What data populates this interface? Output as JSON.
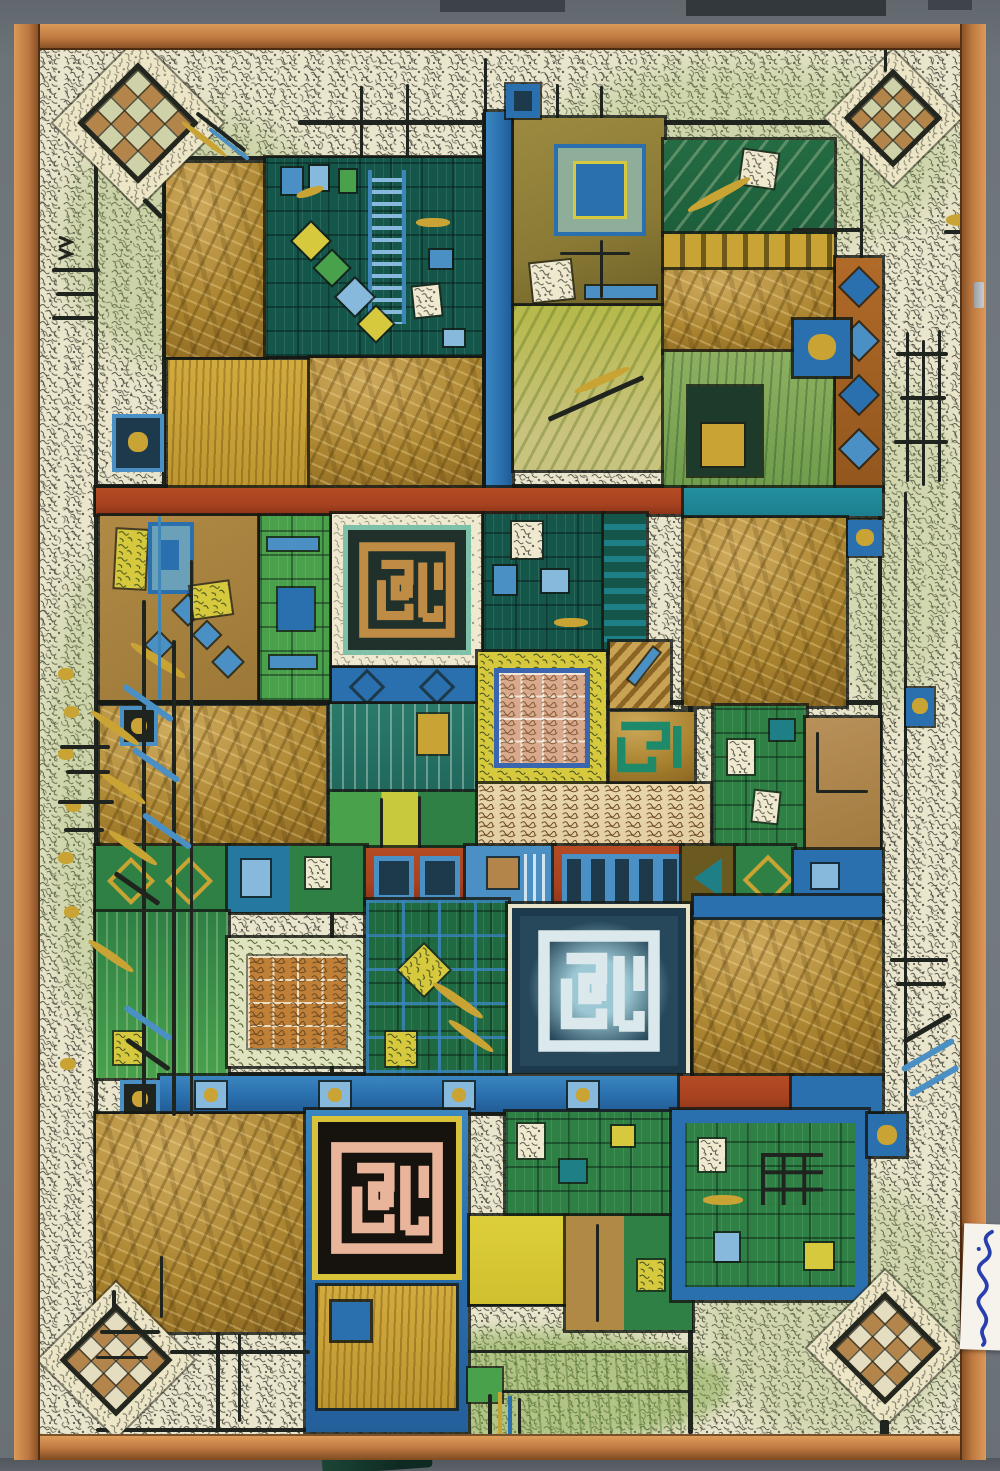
{
  "artwork": {
    "title": "Abstract calligraphic composition",
    "medium": "mixed-media painting in a wooden strip frame, photographed on a grey wall",
    "style": "square Kufic calligraphy, patchwork grid of gold, green, blue and rust panels over a dense script ground"
  },
  "palette": {
    "wall": "#6e757b",
    "wallDark": "#3c4247",
    "frame": "#bd7740",
    "frameLight": "#dc9a58",
    "frameDark": "#7e4a20",
    "canvas": "#eae6cd",
    "ink": "#20241e",
    "washGreen": "#8fae5e",
    "gold": "#a9832f",
    "goldLight": "#cda95c",
    "goldBright": "#c9a434",
    "tan": "#b3854a",
    "olive": "#8a7a35",
    "dkteal": "#14564a",
    "teal": "#1f7f86",
    "green": "#2e8044",
    "brightGreen": "#49a14c",
    "paleGreen": "#dfe3c0",
    "cobalt": "#2a6fae",
    "steel": "#4a90c4",
    "lightBlue": "#86b9dc",
    "navy": "#1c3a4c",
    "rust": "#a84320",
    "cream": "#efe9cf",
    "yellow": "#d6c93e",
    "pink": "#d8a98c",
    "mazePink": "#e8b49a",
    "manuscript": "#e2cda4",
    "manuscriptInk": "#6e4a22",
    "orange": "#c08038",
    "label": "#f5f3ec",
    "signature": "#2a3fae",
    "mazeGold": "#bf8c46",
    "mazeField": "#20302a",
    "mazeNavy": "#26485a",
    "mazeWhite": "#dce9ec",
    "mazeBlack": "#16120d",
    "mazeYellow": "#d8c23a",
    "tealRing": "#7fc0a8"
  },
  "motifs": {
    "corner_diamond_checkerboards": {
      "count": 4,
      "cells": "4x4",
      "border": "calligraphy band"
    },
    "kufic_maze_squares": [
      {
        "position": "upper-middle-left",
        "strokes": "gold on dark green, cream frame, teal ring"
      },
      {
        "position": "center",
        "strokes": "white on navy blue"
      },
      {
        "position": "lower-middle-left",
        "strokes": "pink on black, yellow frame, blue surround"
      }
    ],
    "magic_square_panel": {
      "grid": "4x4",
      "field": "pink with numerals",
      "border": "yellow calligraphy"
    },
    "glyph_grid_panel": {
      "grid": "4x4",
      "field": "orange with calligraphy",
      "border": "pale green script"
    },
    "manuscript_band": {
      "lines": 6,
      "ink": "brown on cream"
    },
    "signature_card": {
      "location": "right frame edge",
      "script": "blue arabic handwriting"
    }
  }
}
